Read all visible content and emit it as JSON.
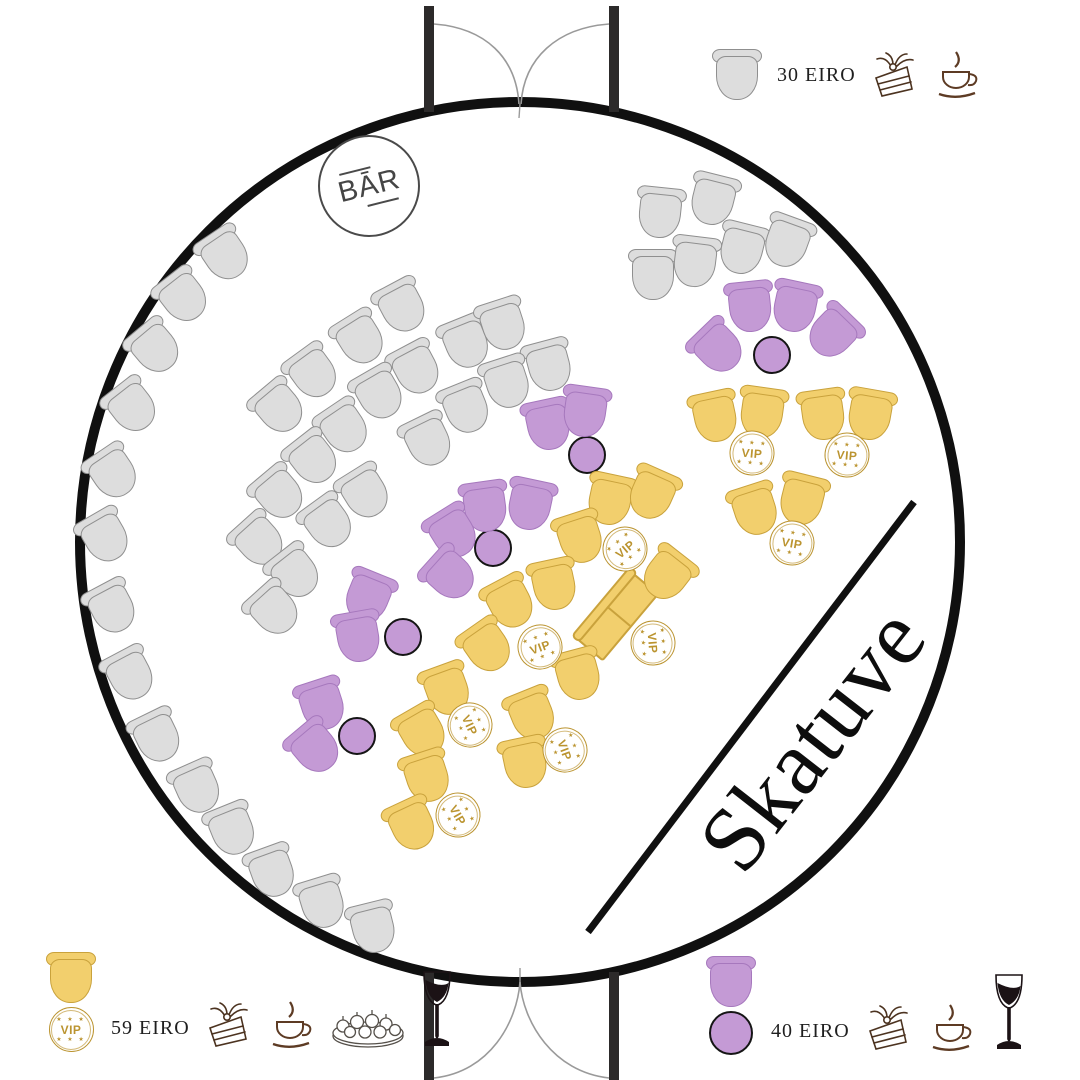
{
  "labels": {
    "bar": "BĀR",
    "stage": "Skatuve",
    "vip": "VIP"
  },
  "legends": {
    "standard": {
      "price": "30 EIRO",
      "seat": "gray-chair",
      "perks": [
        "cake",
        "coffee"
      ]
    },
    "vip": {
      "price": "59 EIRO",
      "seat": "gold-chair-vip",
      "perks": [
        "cake",
        "coffee",
        "canapes",
        "wine"
      ]
    },
    "table": {
      "price": "40 EIRO",
      "seat": "purple-chair-round-table",
      "perks": [
        "cake",
        "coffee",
        "wine"
      ]
    }
  },
  "colors": {
    "gray_seat": "#dddddd",
    "gray_border": "#8f8f8f",
    "gold_seat": "#f2cf6d",
    "gold_border": "#c9a23c",
    "purple_seat": "#c49ad5",
    "purple_border": "#a678bd",
    "vip_gold": "#bb9430",
    "wall_ink": "#101010",
    "icon_brown": "#4c3320"
  },
  "map": {
    "seats": [
      {
        "x": 225,
        "y": 255,
        "r": -34,
        "t": "g"
      },
      {
        "x": 183,
        "y": 297,
        "r": -38,
        "t": "g"
      },
      {
        "x": 155,
        "y": 348,
        "r": -40,
        "t": "g"
      },
      {
        "x": 132,
        "y": 407,
        "r": -38,
        "t": "g"
      },
      {
        "x": 113,
        "y": 473,
        "r": -34,
        "t": "g"
      },
      {
        "x": 105,
        "y": 537,
        "r": -30,
        "t": "g"
      },
      {
        "x": 112,
        "y": 608,
        "r": -28,
        "t": "g"
      },
      {
        "x": 130,
        "y": 675,
        "r": -28,
        "t": "g"
      },
      {
        "x": 157,
        "y": 737,
        "r": -26,
        "t": "g"
      },
      {
        "x": 197,
        "y": 788,
        "r": -24,
        "t": "g"
      },
      {
        "x": 232,
        "y": 830,
        "r": -22,
        "t": "g"
      },
      {
        "x": 272,
        "y": 872,
        "r": -20,
        "t": "g"
      },
      {
        "x": 322,
        "y": 903,
        "r": -17,
        "t": "g"
      },
      {
        "x": 373,
        "y": 928,
        "r": -14,
        "t": "g"
      },
      {
        "x": 402,
        "y": 307,
        "r": -28,
        "t": "g"
      },
      {
        "x": 360,
        "y": 339,
        "r": -32,
        "t": "g"
      },
      {
        "x": 466,
        "y": 343,
        "r": -22,
        "t": "g"
      },
      {
        "x": 503,
        "y": 325,
        "r": -18,
        "t": "g"
      },
      {
        "x": 549,
        "y": 366,
        "r": -15,
        "t": "g"
      },
      {
        "x": 416,
        "y": 369,
        "r": -28,
        "t": "g"
      },
      {
        "x": 379,
        "y": 394,
        "r": -30,
        "t": "g"
      },
      {
        "x": 313,
        "y": 373,
        "r": -36,
        "t": "g"
      },
      {
        "x": 279,
        "y": 408,
        "r": -40,
        "t": "g"
      },
      {
        "x": 466,
        "y": 408,
        "r": -22,
        "t": "g"
      },
      {
        "x": 507,
        "y": 383,
        "r": -18,
        "t": "g"
      },
      {
        "x": 344,
        "y": 428,
        "r": -34,
        "t": "g"
      },
      {
        "x": 428,
        "y": 441,
        "r": -26,
        "t": "g"
      },
      {
        "x": 313,
        "y": 459,
        "r": -38,
        "t": "g"
      },
      {
        "x": 279,
        "y": 494,
        "r": -40,
        "t": "g"
      },
      {
        "x": 365,
        "y": 493,
        "r": -32,
        "t": "g"
      },
      {
        "x": 328,
        "y": 523,
        "r": -36,
        "t": "g"
      },
      {
        "x": 259,
        "y": 541,
        "r": -42,
        "t": "g"
      },
      {
        "x": 295,
        "y": 573,
        "r": -38,
        "t": "g"
      },
      {
        "x": 274,
        "y": 610,
        "r": -42,
        "t": "g"
      },
      {
        "x": 660,
        "y": 213,
        "r": 6,
        "t": "g"
      },
      {
        "x": 713,
        "y": 200,
        "r": 14,
        "t": "g"
      },
      {
        "x": 653,
        "y": 275,
        "r": 0,
        "t": "g"
      },
      {
        "x": 695,
        "y": 262,
        "r": 7,
        "t": "g"
      },
      {
        "x": 742,
        "y": 249,
        "r": 14,
        "t": "g"
      },
      {
        "x": 787,
        "y": 242,
        "r": 20,
        "t": "g"
      },
      {
        "x": 610,
        "y": 500,
        "r": 12,
        "t": "y"
      },
      {
        "x": 652,
        "y": 494,
        "r": 24,
        "t": "y"
      },
      {
        "x": 580,
        "y": 538,
        "r": -18,
        "t": "y"
      },
      {
        "x": 554,
        "y": 585,
        "r": -12,
        "t": "y"
      },
      {
        "x": 510,
        "y": 603,
        "r": -28,
        "t": "y"
      },
      {
        "x": 487,
        "y": 647,
        "r": -35,
        "t": "y"
      },
      {
        "x": 447,
        "y": 690,
        "r": -20,
        "t": "y"
      },
      {
        "x": 422,
        "y": 732,
        "r": -30,
        "t": "y"
      },
      {
        "x": 427,
        "y": 777,
        "r": -18,
        "t": "y"
      },
      {
        "x": 412,
        "y": 825,
        "r": -25,
        "t": "y"
      },
      {
        "x": 755,
        "y": 510,
        "r": -18,
        "t": "y"
      },
      {
        "x": 802,
        "y": 500,
        "r": 14,
        "t": "y"
      },
      {
        "x": 715,
        "y": 417,
        "r": -12,
        "t": "y"
      },
      {
        "x": 762,
        "y": 413,
        "r": 8,
        "t": "y"
      },
      {
        "x": 823,
        "y": 415,
        "r": -8,
        "t": "y"
      },
      {
        "x": 870,
        "y": 415,
        "r": 10,
        "t": "y"
      },
      {
        "x": 667,
        "y": 575,
        "r": 38,
        "t": "y"
      },
      {
        "x": 578,
        "y": 675,
        "r": -15,
        "t": "y"
      },
      {
        "x": 532,
        "y": 715,
        "r": -22,
        "t": "y"
      },
      {
        "x": 525,
        "y": 763,
        "r": -12,
        "t": "y"
      },
      {
        "x": 750,
        "y": 307,
        "r": -6,
        "t": "p"
      },
      {
        "x": 795,
        "y": 307,
        "r": 12,
        "t": "p"
      },
      {
        "x": 833,
        "y": 333,
        "r": 44,
        "t": "p"
      },
      {
        "x": 718,
        "y": 348,
        "r": -44,
        "t": "p"
      },
      {
        "x": 548,
        "y": 425,
        "r": -12,
        "t": "p"
      },
      {
        "x": 585,
        "y": 412,
        "r": 8,
        "t": "p"
      },
      {
        "x": 485,
        "y": 507,
        "r": -8,
        "t": "p"
      },
      {
        "x": 530,
        "y": 505,
        "r": 12,
        "t": "p"
      },
      {
        "x": 453,
        "y": 533,
        "r": -32,
        "t": "p"
      },
      {
        "x": 450,
        "y": 575,
        "r": -48,
        "t": "p"
      },
      {
        "x": 368,
        "y": 597,
        "r": 22,
        "t": "p"
      },
      {
        "x": 358,
        "y": 637,
        "r": -10,
        "t": "p"
      },
      {
        "x": 322,
        "y": 705,
        "r": -18,
        "t": "p"
      },
      {
        "x": 315,
        "y": 748,
        "r": -40,
        "t": "p"
      }
    ],
    "tables": [
      {
        "x": 772,
        "y": 355
      },
      {
        "x": 587,
        "y": 455
      },
      {
        "x": 493,
        "y": 548
      },
      {
        "x": 403,
        "y": 637
      },
      {
        "x": 357,
        "y": 736
      }
    ],
    "vip_badges": [
      {
        "x": 625,
        "y": 549,
        "r": -40
      },
      {
        "x": 540,
        "y": 647,
        "r": -20
      },
      {
        "x": 470,
        "y": 725,
        "r": 65
      },
      {
        "x": 458,
        "y": 815,
        "r": 60
      },
      {
        "x": 752,
        "y": 453,
        "r": 5
      },
      {
        "x": 847,
        "y": 455,
        "r": 5
      },
      {
        "x": 792,
        "y": 543,
        "r": 10
      },
      {
        "x": 653,
        "y": 643,
        "r": 85
      },
      {
        "x": 565,
        "y": 750,
        "r": 70
      }
    ],
    "sofa": {
      "x": 618,
      "y": 617,
      "r": -50
    }
  }
}
